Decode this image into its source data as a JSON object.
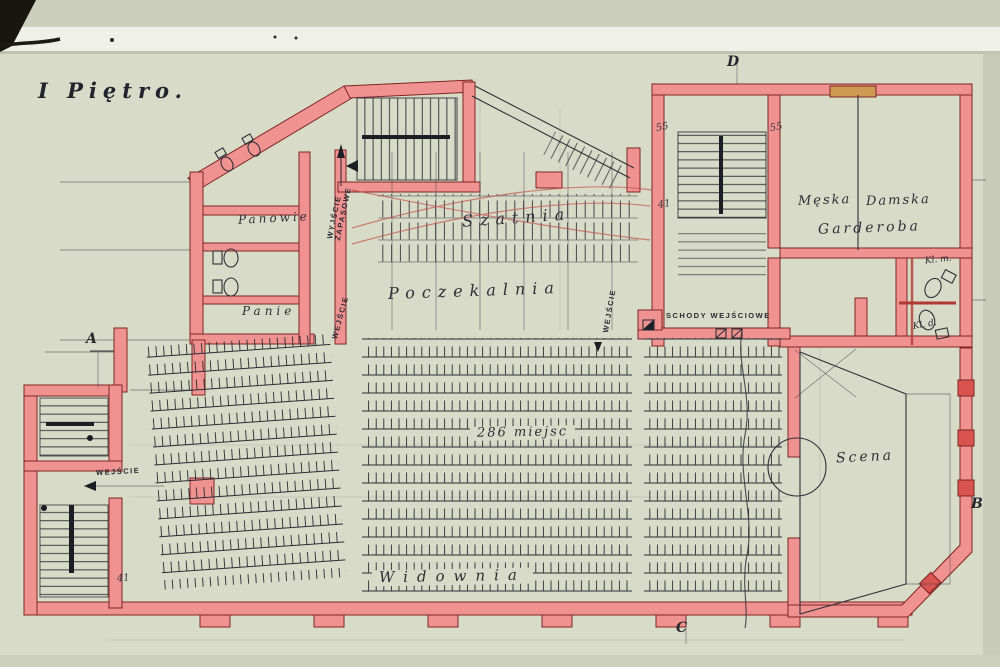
{
  "plan": {
    "title": "I Piętro.",
    "rooms": {
      "szatnia": "Szatnia",
      "poczekalnia": "Poczekalnia",
      "widownia": "Widownia",
      "scena": "Scena",
      "panowie": "Panowie",
      "panie": "Panie",
      "garderoba_meska": "Męska",
      "garderoba_damska": "Damska",
      "garderoba": "Garderoba",
      "wc_men": "Kl. m.",
      "wc_women": "Kl. d."
    },
    "labels": {
      "seats_count": "286 miejsc",
      "entrance_stairs": "SCHODY WEJŚCIOWE",
      "exit_emergency_line1": "WYJŚCIE",
      "exit_emergency_line2": "ZAPASOWE",
      "entrance": "WEJŚCIE"
    },
    "dimensions": {
      "stair_right_a": "55",
      "stair_right_b": "55",
      "stair_right_c": "41",
      "stair_left": "41"
    },
    "markers": {
      "a": "A",
      "b": "B",
      "c": "C",
      "d": "D"
    },
    "colors": {
      "wall_pink": "#f09290",
      "wall_outline": "#7e2523",
      "ink": "#30303a",
      "paper": "#d8dbc7",
      "pencil_red": "#c4544e",
      "patch_orange": "#cf9a52",
      "window_red": "#d9534f"
    }
  }
}
